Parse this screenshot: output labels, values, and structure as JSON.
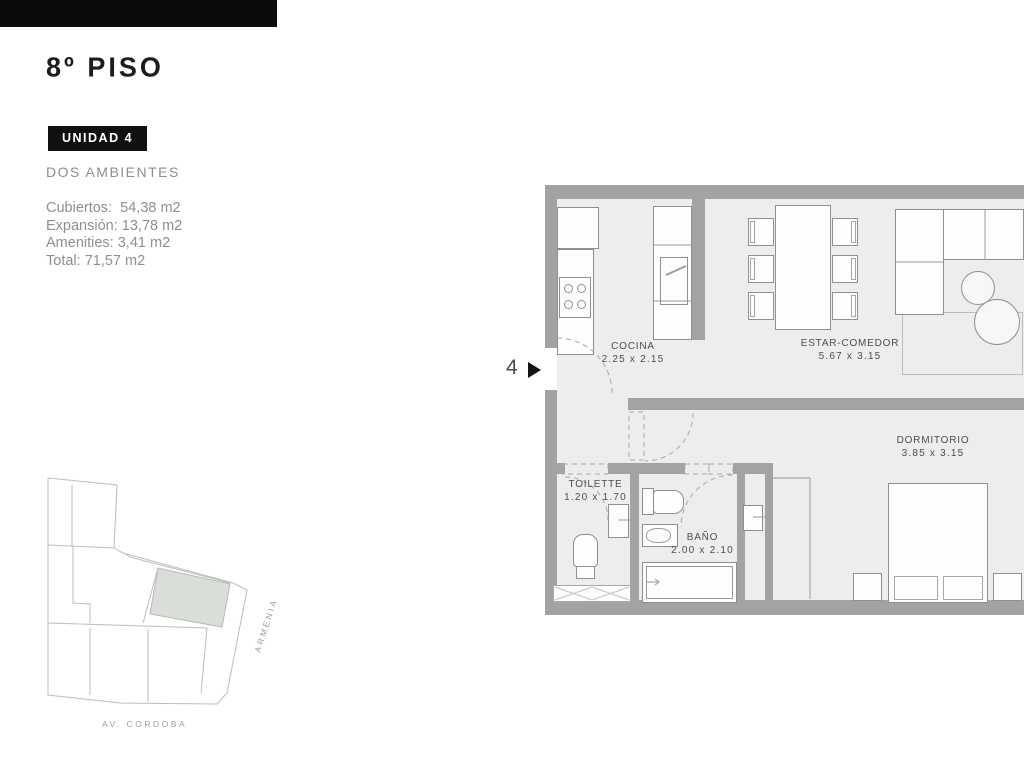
{
  "header": {
    "title": "8º PISO",
    "unit_badge": "UNIDAD 4",
    "subtitle": "DOS AMBIENTES"
  },
  "areas": {
    "rows": [
      {
        "label": "Cubiertos:",
        "value": "54,38 m2"
      },
      {
        "label": "Expansión:",
        "value": "13,78 m2"
      },
      {
        "label": "Amenities:",
        "value": "3,41 m2"
      },
      {
        "label": "Total:",
        "value": "71,57 m2"
      }
    ]
  },
  "plan": {
    "unit_marker": "4",
    "rooms": {
      "cocina": {
        "name": "COCINA",
        "dims": "2.25 x 2.15"
      },
      "estar": {
        "name": "ESTAR-COMEDOR",
        "dims": "5.67 x 3.15"
      },
      "dormitorio": {
        "name": "DORMITORIO",
        "dims": "3.85 x 3.15"
      },
      "toilette": {
        "name": "TOILETTE",
        "dims": "1.20 x 1.70"
      },
      "bano": {
        "name": "BAÑO",
        "dims": "2.00 x 2.10"
      }
    }
  },
  "map": {
    "street_side": "ARMENIA",
    "street_bottom": "AV. CORDOBA"
  },
  "colors": {
    "wall": "#a3a3a3",
    "floor": "#edeeeb",
    "badge_bg": "#101010",
    "highlight_parcel": "#d9ded9",
    "text_gray": "#8f8f8f"
  }
}
